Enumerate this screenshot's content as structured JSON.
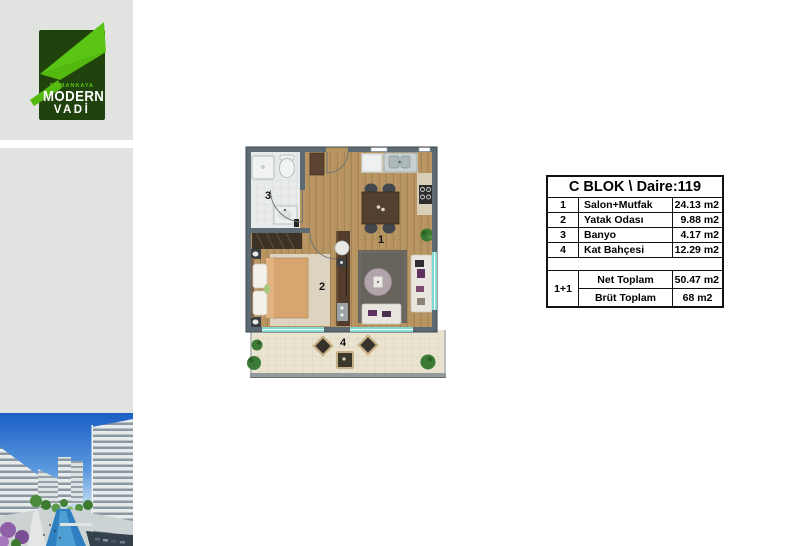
{
  "logo": {
    "brand": "DUMANKAYA",
    "line1": "MODERN",
    "line2": "VADİ",
    "brand_green": "#5bc515",
    "brand_dark_green": "#20430e"
  },
  "plan": {
    "labels": {
      "salon": "1",
      "yatak": "2",
      "banyo": "3",
      "kat_bahcesi": "4"
    },
    "colors": {
      "wall": "#5c6b73",
      "wood_floor": "#b5935f",
      "window_teal": "#7fd8d2",
      "terrace": "#e9e3d0"
    }
  },
  "unit_table": {
    "title": "C BLOK \\ Daire:119",
    "rows": [
      {
        "num": "1",
        "name": "Salon+Mutfak",
        "area": "24.13 m2"
      },
      {
        "num": "2",
        "name": "Yatak Odası",
        "area": "9.88 m2"
      },
      {
        "num": "3",
        "name": "Banyo",
        "area": "4.17 m2"
      },
      {
        "num": "4",
        "name": "Kat Bahçesi",
        "area": "12.29 m2"
      }
    ],
    "type_label": "1+1",
    "totals": [
      {
        "name": "Net Toplam",
        "area": "50.47 m2"
      },
      {
        "name": "Brüt Toplam",
        "area": "68 m2"
      }
    ]
  }
}
